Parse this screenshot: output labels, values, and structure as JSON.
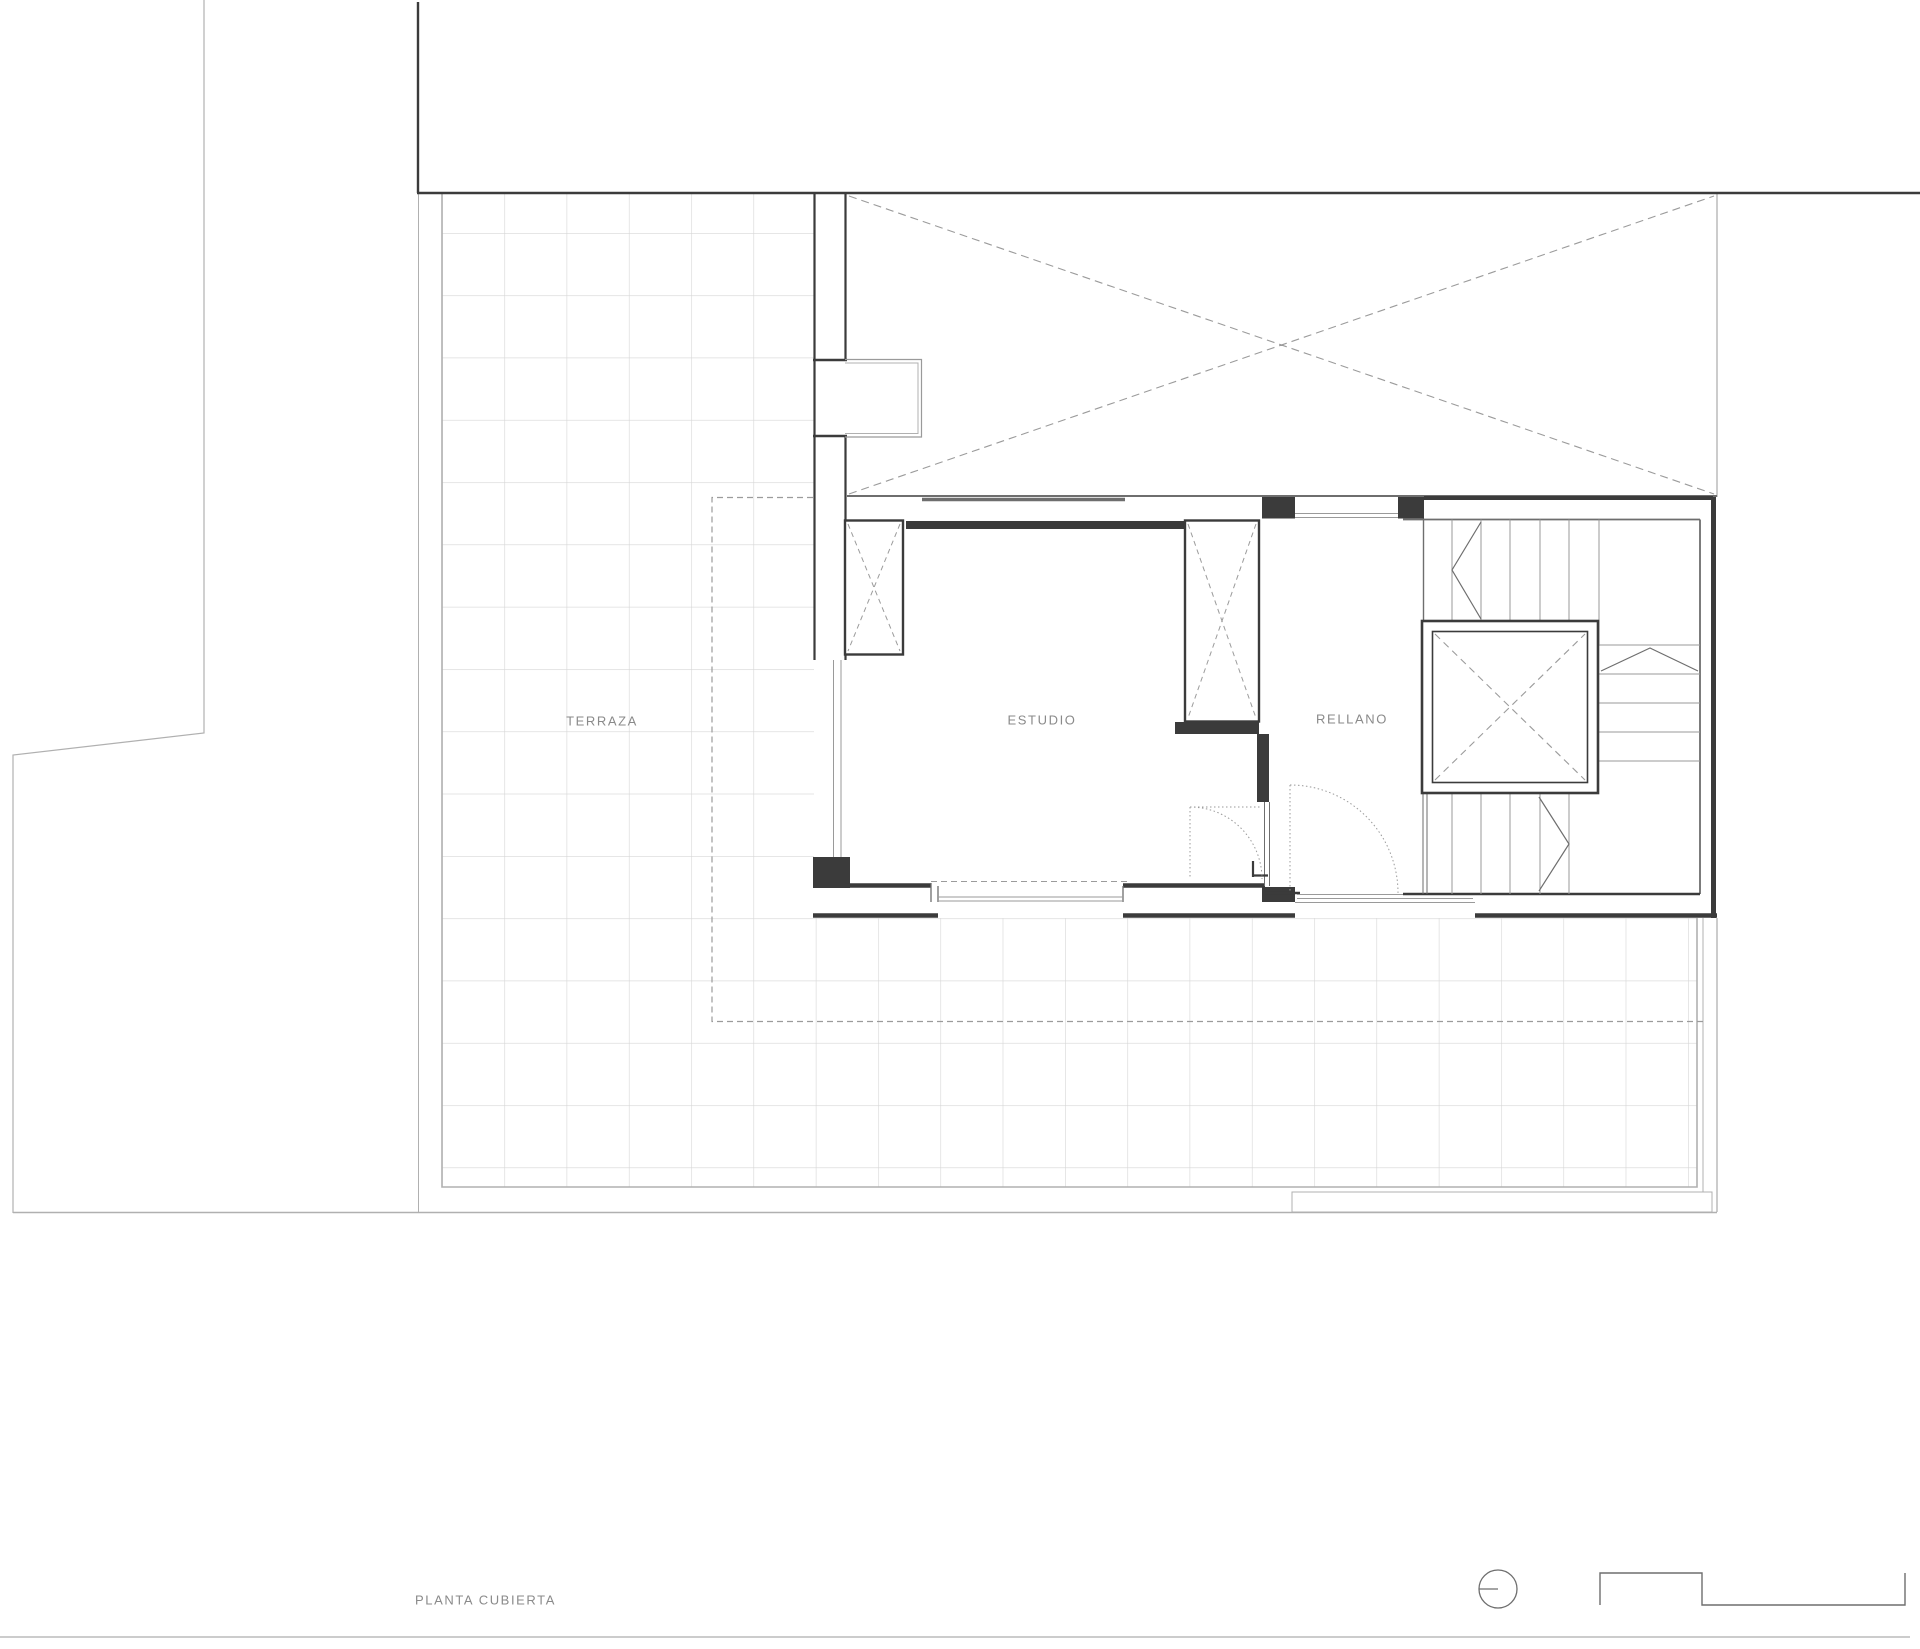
{
  "drawing": {
    "title": "PLANTA CUBIERTA",
    "type": "roof-floor-plan"
  },
  "labels": [
    {
      "id": "terraza",
      "text": "TERRAZA",
      "x": 602,
      "y": 721,
      "align": "center"
    },
    {
      "id": "estudio",
      "text": "ESTUDIO",
      "x": 1042,
      "y": 720,
      "align": "center"
    },
    {
      "id": "rellano",
      "text": "RELLANO",
      "x": 1352,
      "y": 719,
      "align": "center"
    },
    {
      "id": "title",
      "text": "PLANTA CUBIERTA",
      "x": 415,
      "y": 1600,
      "align": "left"
    }
  ],
  "symbols": [
    {
      "id": "north-symbol",
      "shape": "circle-with-radius-line"
    },
    {
      "id": "section-profile-symbol",
      "shape": "stepped-polyline"
    }
  ],
  "colors": {
    "wall": "#3b3b3b",
    "line_med": "#6e6e6e",
    "line_light": "#9a9a9a",
    "boundary": "#b0b0b0",
    "tile": "#d6d6d6",
    "dashed": "#9b9b9b",
    "text": "#8a8a8a"
  }
}
